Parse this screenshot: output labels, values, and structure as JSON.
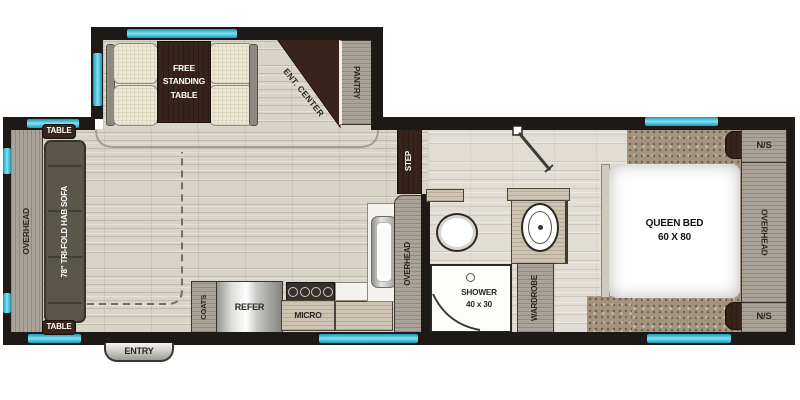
{
  "plan": {
    "type": "travel-trailer floor plan",
    "slideout": {
      "dinette_table_label": "FREE\nSTANDING\nTABLE",
      "ent_center_label": "ENT. CENTER",
      "pantry_label": "PANTRY"
    },
    "living": {
      "overhead_label": "OVERHEAD",
      "table_top_label": "TABLE",
      "table_bottom_label": "TABLE",
      "sofa_label": "78\" TRI-FOLD HAB SOFA",
      "entry_label": "ENTRY"
    },
    "kitchen": {
      "coats_label": "COATS",
      "refer_label": "REFER",
      "micro_label": "MICRO",
      "overhead_label": "OVERHEAD",
      "step_label": "STEP"
    },
    "bath": {
      "shower_label": "SHOWER\n40 x 30",
      "wardrobe_label": "WARDROBE"
    },
    "bedroom": {
      "bed_label": "QUEEN BED\n60 X 80",
      "overhead_label": "OVERHEAD",
      "ns_top_label": "N/S",
      "ns_bottom_label": "N/S"
    },
    "colors": {
      "wall": "#1c1916",
      "window_teal": "#23b3d2",
      "dark_wood": "#38241a",
      "cabinet_gray": "#a9a39a",
      "floor_wood": "#d9d4c9",
      "raised_floor": "#e2ddd4",
      "carpet": "#a3937f",
      "cushion_cream": "#ece8d2",
      "sofa_taupe": "#5b564b"
    }
  }
}
